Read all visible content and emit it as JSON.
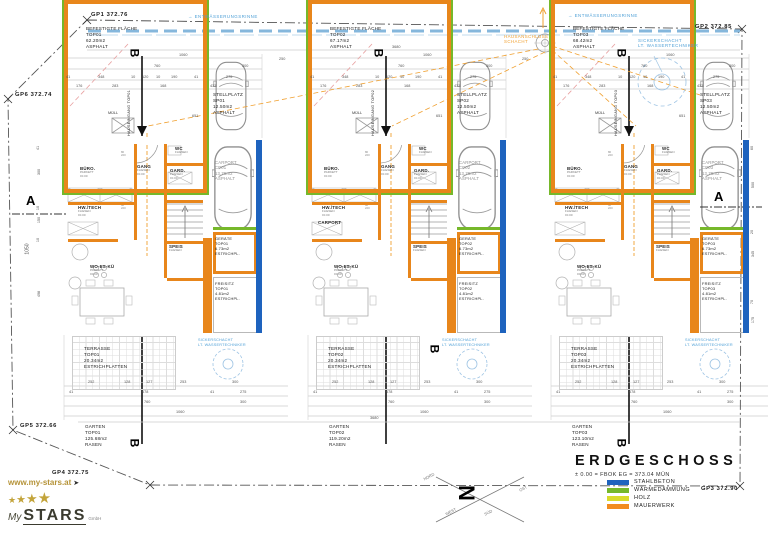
{
  "colors": {
    "wall_orange": "#E8861B",
    "insulation_green": "#76B82A",
    "concrete_blue": "#1E63BE",
    "wood_yellow": "#D9DC2B",
    "water_blue": "#4D9FD6",
    "service_orange": "#F0A030"
  },
  "units": [
    {
      "id": "TOP01",
      "befestigte": {
        "l1": "BEFESTIGTE FLÄCHE",
        "l2": "TOP01",
        "l3": "62.20m2",
        "l4": "ASPHALT"
      },
      "stellplatz": {
        "l1": "STELLPLATZ",
        "l2": "SP01",
        "l3": "12.50m2",
        "l4": "ASPHALT"
      },
      "hauseingang": "HAUSEINGANG TOP01",
      "muell": "MÜLL",
      "section_b": "B",
      "carport": {
        "l1": "CARPORT",
        "l2": "CP01",
        "l3": "13.75m2",
        "l4": "ASPHALT"
      },
      "geraete": {
        "l1": "GERÄTE",
        "l2": "TOP01",
        "l3": "6.73m2",
        "l4": "ESTRICHPL."
      },
      "freisitz": {
        "l1": "FREISITZ",
        "l2": "TOP01",
        "l3": "4.81m2",
        "l4": "ESTRICHPL."
      },
      "terrasse": {
        "l1": "TERRASSE",
        "l2": "TOP01",
        "l3": "20.34m2",
        "l4": "ESTRICHPLATTEN"
      },
      "garten": {
        "l1": "GARTEN",
        "l2": "TOP01",
        "l3": "125.68m2",
        "l4": "RASEN"
      },
      "sicker": {
        "l1": "SICKERSCHACHT",
        "l2": "LT. WASSERTECHNIKER"
      },
      "rooms": {
        "buero": "BÜRO.",
        "gang": "GANG",
        "gard": "GARD.",
        "wc": "WC",
        "hwtech": "HW./TECH",
        "speis": "SPEIS",
        "wohnen": "WO-ES-KÜ",
        "extra": ""
      }
    },
    {
      "id": "TOP02",
      "befestigte": {
        "l1": "BEFESTIGTE FLÄCHE",
        "l2": "TOP02",
        "l3": "67.17m2",
        "l4": "ASPHALT"
      },
      "stellplatz": {
        "l1": "STELLPLATZ",
        "l2": "SP02",
        "l3": "12.50m2",
        "l4": "ASPHALT"
      },
      "hauseingang": "HAUSEINGANG TOP02",
      "muell": "MÜLL",
      "section_b": "B",
      "carport": {
        "l1": "CARPORT",
        "l2": "CP02",
        "l3": "13.75m2",
        "l4": "ASPHALT"
      },
      "geraete": {
        "l1": "GERÄTE",
        "l2": "TOP02",
        "l3": "6.73m2",
        "l4": "ESTRICHPL."
      },
      "freisitz": {
        "l1": "FREISITZ",
        "l2": "TOP02",
        "l3": "4.81m2",
        "l4": "ESTRICHPL."
      },
      "terrasse": {
        "l1": "TERRASSE",
        "l2": "TOP02",
        "l3": "20.34m2",
        "l4": "ESTRICHPLATTEN"
      },
      "garten": {
        "l1": "GARTEN",
        "l2": "TOP02",
        "l3": "119.20m2",
        "l4": "RASEN"
      },
      "sicker": {
        "l1": "SICKERSCHACHT",
        "l2": "LT. WASSERTECHNIKER"
      },
      "rooms": {
        "buero": "BÜRO.",
        "gang": "GANG",
        "gard": "GARD.",
        "wc": "WC",
        "hwtech": "HW./TECH",
        "speis": "SPEIS",
        "wohnen": "WO-ES-KÜ",
        "extra": "CARPORT"
      }
    },
    {
      "id": "TOP03",
      "befestigte": {
        "l1": "BEFESTIGTE FLÄCHE",
        "l2": "TOP03",
        "l3": "68.42m2",
        "l4": "ASPHALT"
      },
      "stellplatz": {
        "l1": "STELLPLATZ",
        "l2": "SP03",
        "l3": "12.50m2",
        "l4": "ASPHALT"
      },
      "hauseingang": "HAUSEINGANG TOP03",
      "muell": "MÜLL",
      "section_b": "B",
      "carport": {
        "l1": "CARPORT",
        "l2": "CP03",
        "l3": "13.75m2",
        "l4": "ASPHALT"
      },
      "geraete": {
        "l1": "GERÄTE",
        "l2": "TOP03",
        "l3": "6.73m2",
        "l4": "ESTRICHPL."
      },
      "freisitz": {
        "l1": "FREISITZ",
        "l2": "TOP03",
        "l3": "4.81m2",
        "l4": "ESTRICHPL."
      },
      "terrasse": {
        "l1": "TERRASSE",
        "l2": "TOP03",
        "l3": "20.34m2",
        "l4": "ESTRICHPLATTEN"
      },
      "garten": {
        "l1": "GARTEN",
        "l2": "TOP03",
        "l3": "123.10m2",
        "l4": "RASEN"
      },
      "sicker": {
        "l1": "SICKERSCHACHT",
        "l2": "LT. WASSERTECHNIKER"
      },
      "rooms": {
        "buero": "BÜRO.",
        "gang": "GANG",
        "gard": "GARD.",
        "wc": "WC",
        "hwtech": "HW./TECH",
        "speis": "SPEIS",
        "wohnen": "WO-ES-KÜ",
        "extra": ""
      }
    }
  ],
  "room_sub": {
    "parkett": "PARKETT",
    "fliesen": "FLIESEN",
    "level": "±0.00"
  },
  "door_tag": {
    "w": "80",
    "h": "220"
  },
  "dims": {
    "top": [
      [
        "1060"
      ],
      [
        "760",
        "300"
      ],
      [
        "41",
        "348",
        "10",
        "120",
        "10",
        "190",
        "41",
        "275"
      ],
      [
        "176",
        "283",
        "168",
        "433"
      ]
    ],
    "bottom": [
      [
        "252",
        "128",
        "127",
        "253",
        "300"
      ],
      [
        "41",
        "678",
        "41",
        "275"
      ],
      [
        "760",
        "300"
      ],
      [
        "1060"
      ]
    ],
    "left": [
      "41",
      "300",
      "10",
      "150",
      "10",
      "498"
    ],
    "left_big": "1050",
    "right": [
      "60",
      "500",
      "20",
      "345",
      "70",
      "175"
    ],
    "between": "250",
    "total": "3680",
    "stall": "651"
  },
  "gp": {
    "gp1": "GP1 372.76",
    "gp2": "GP2 372.85",
    "gp3": "GP3 372.90",
    "gp4": "GP4 372.75",
    "gp5": "GP5 372.66",
    "gp6": "GP6 372.74"
  },
  "annotations": {
    "entwaesserung": "ENTWÄSSERUNGSRINNE",
    "flow_arrow": "→",
    "hausanschluss": {
      "l1": "HAUSANSCHLUSS",
      "l2": "SCHACHT"
    },
    "sicker_top": {
      "l1": "SICKERSCHACHT",
      "l2": "LT. WASSERTECHNIKER"
    },
    "section_a": "A"
  },
  "legend": {
    "title": "ERDGESCHOSS",
    "subtitle": "± 0.00 = FBOK EG = 373.04 MÜN",
    "items": [
      {
        "label": "STAHLBETON",
        "color": "#1E63BE"
      },
      {
        "label": "WÄRMEDÄMMUNG",
        "color": "#76B82A"
      },
      {
        "label": "HOLZ",
        "color": "#D9DC2B"
      },
      {
        "label": "MAUERWERK",
        "color": "#F28C1E"
      }
    ]
  },
  "north": {
    "letter": "N",
    "nord": "NORD",
    "ost": "OST",
    "sued": "SÜD",
    "west": "WEST"
  },
  "logo": {
    "url": "www.my-stars.at",
    "arrow": "➤",
    "star": "★",
    "my": "My",
    "stars": "STARS",
    "gmbh": "GmbH"
  }
}
